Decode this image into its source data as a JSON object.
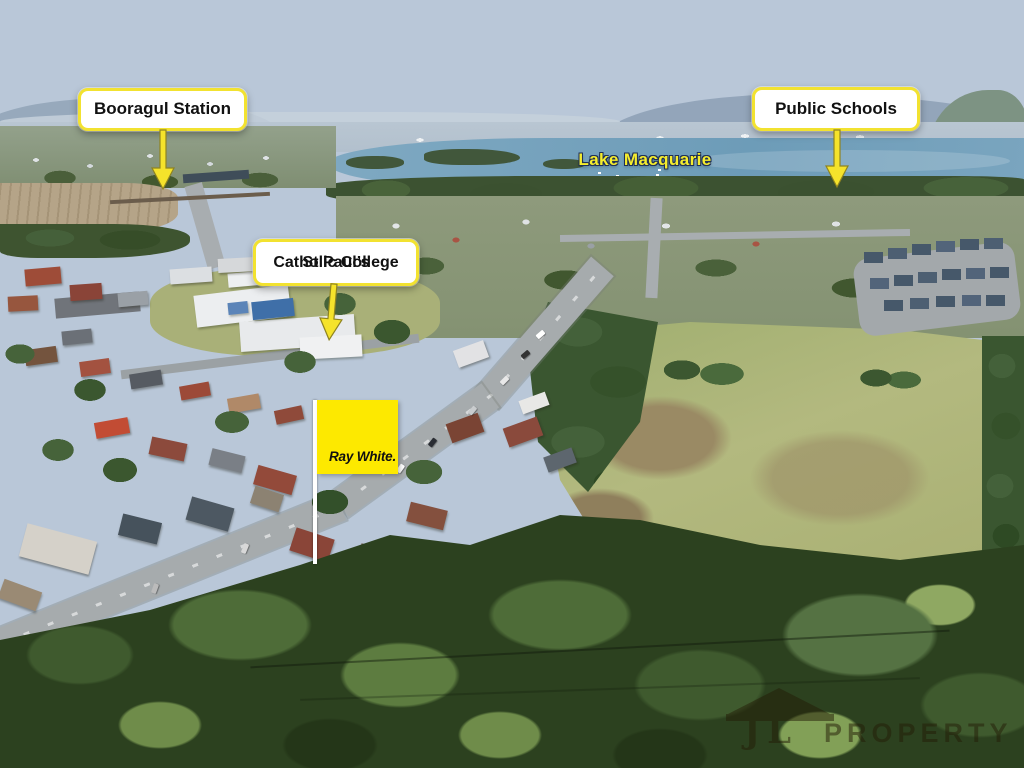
{
  "theme": {
    "accent_yellow": "#F5E32B",
    "label_border": "#F2E230",
    "label_bg": "#FFFFFF",
    "label_text": "#111111",
    "arrow_outline": "#8F8420",
    "lake_label_fill": "#F5ED2E",
    "lake_label_outline": "#203055",
    "rw_flag": "#FDE900",
    "rw_text": "#101010",
    "pole": "#FFFFFF",
    "watermark_color": "#241D07"
  },
  "annotations": {
    "booragul": {
      "label": "Booragul Station"
    },
    "public_schools": {
      "label": "Public Schools"
    },
    "st_pauls": {
      "label_line1": "St Paul’s",
      "label_line2": "Catholic College"
    },
    "lake": {
      "label": "Lake Macquarie"
    }
  },
  "signage": {
    "ray_white": {
      "label": "Ray White."
    }
  },
  "watermark": {
    "initials": "JL",
    "label": "PROPERTY"
  }
}
